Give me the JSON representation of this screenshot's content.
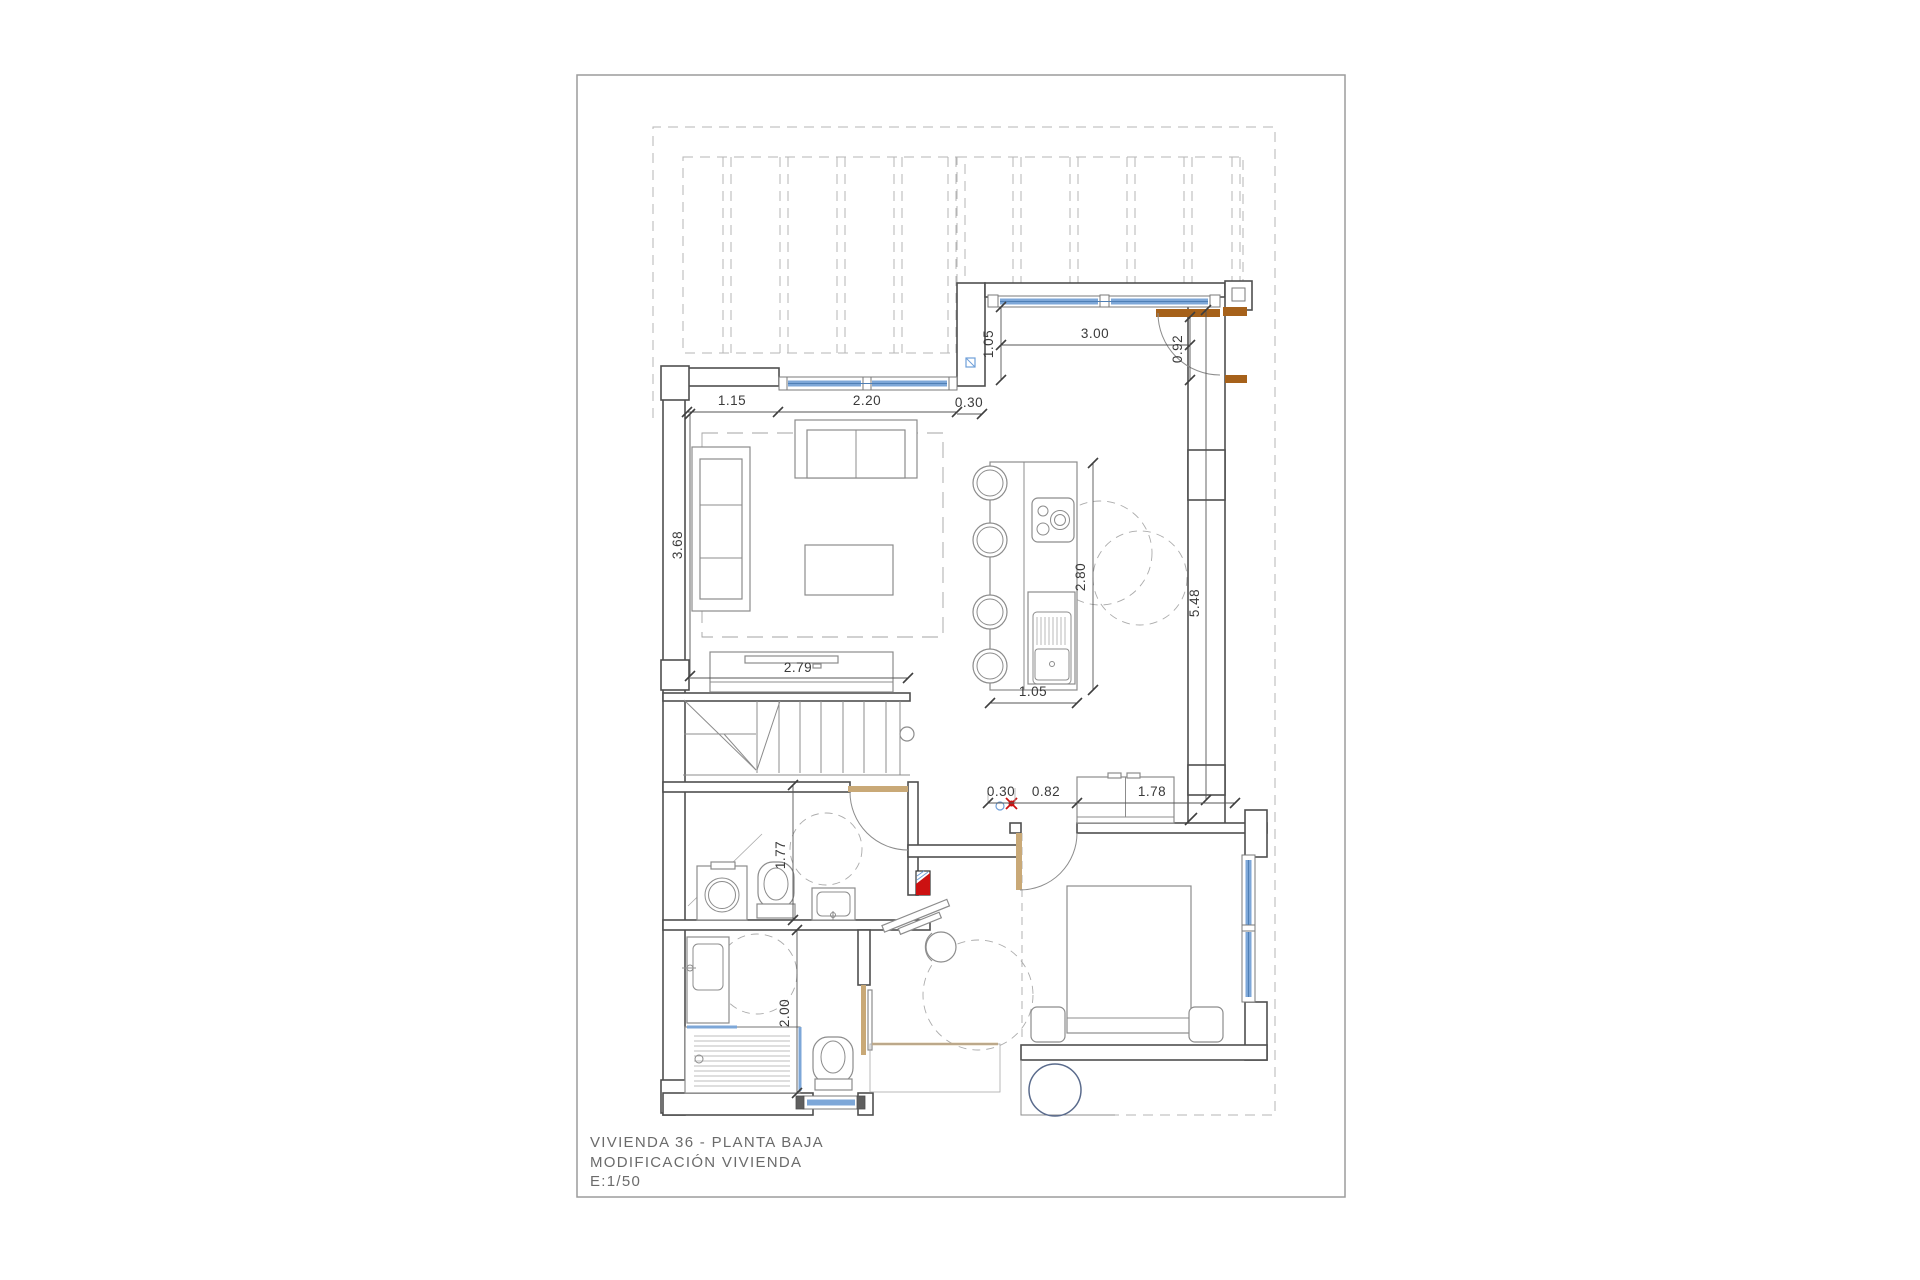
{
  "document": {
    "type": "architectural-floor-plan",
    "title_block": {
      "line1": "VIVIENDA  36  - PLANTA BAJA",
      "line2": "MODIFICACIÓN VIVIENDA",
      "line3": "E:1/50"
    },
    "scale": "1/50",
    "units": "meters"
  },
  "dims": [
    {
      "value": "1.15"
    },
    {
      "value": "2.20"
    },
    {
      "value": "0.30"
    },
    {
      "value": "1.05"
    },
    {
      "value": "3.00"
    },
    {
      "value": "0.92"
    },
    {
      "value": "3.68"
    },
    {
      "value": "2.79"
    },
    {
      "value": "2.80"
    },
    {
      "value": "1.05"
    },
    {
      "value": "5.48"
    },
    {
      "value": "0.30"
    },
    {
      "value": "0.82"
    },
    {
      "value": "1.78"
    },
    {
      "value": "1.77"
    },
    {
      "value": "2.00"
    }
  ],
  "colors": {
    "window_glass": "#7da7d8",
    "window_glass_dark": "#4f7fb5",
    "door_wood_light": "#c9a977",
    "door_wood_dark": "#a6611a",
    "marker_red": "#cc1111",
    "marker_blue": "#6f9fd8",
    "planter_stroke": "#5a6b8c",
    "wall_line": "#4f4f4f",
    "furniture_line": "#8c8c8c",
    "dashed_line": "#b5b5b5",
    "text": "#3a3a3a"
  }
}
